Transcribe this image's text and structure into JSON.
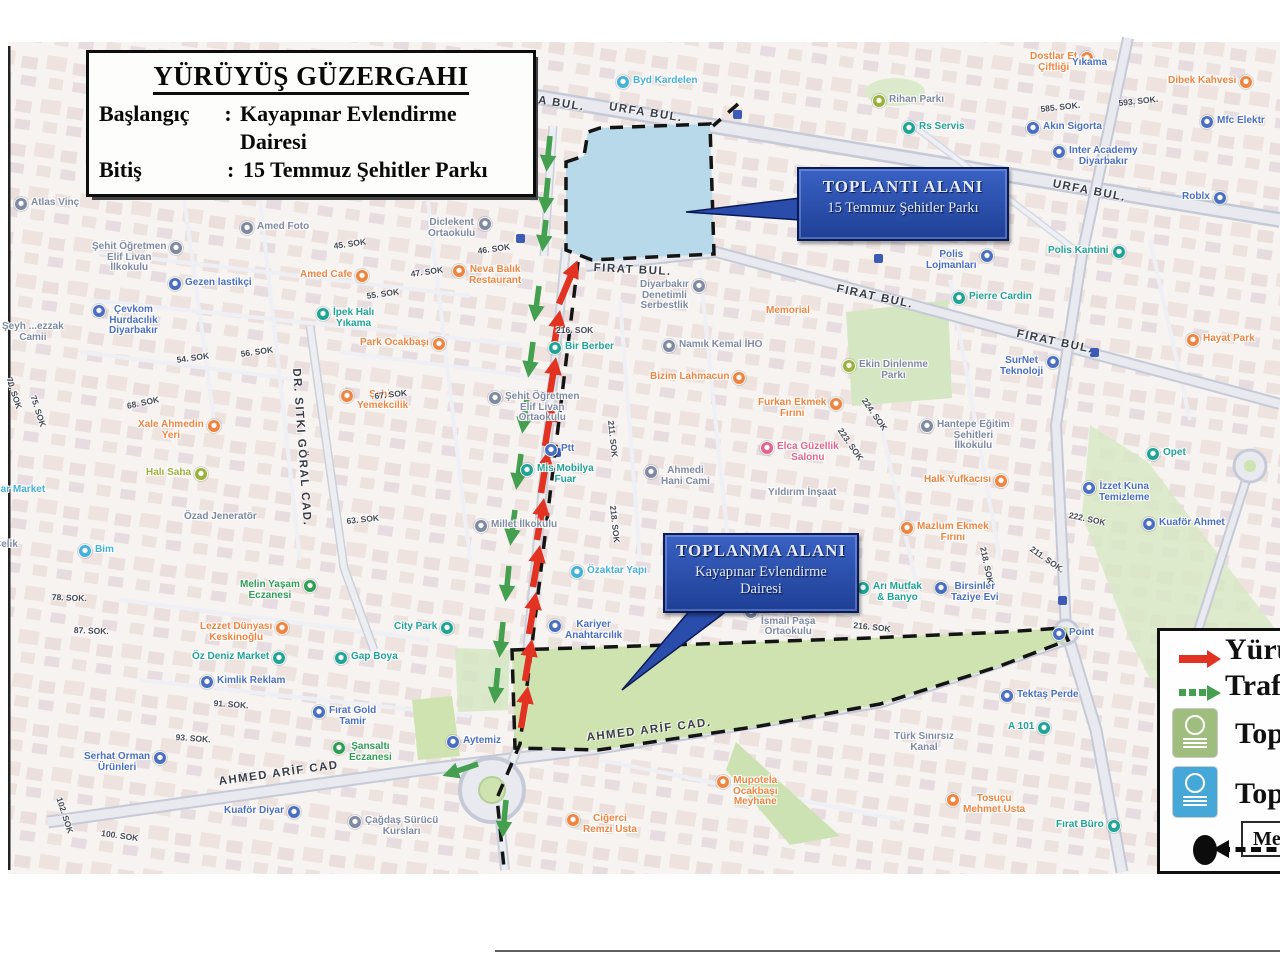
{
  "title_box": {
    "title": "YÜRÜYÜŞ GÜZERGAHI",
    "rows": [
      {
        "label": "Başlangıç",
        "colon": ":",
        "value": "Kayapınar Evlendirme Dairesi"
      },
      {
        "label": "Bitiş",
        "colon": ":",
        "value": "15 Temmuz Şehitler Parkı"
      }
    ]
  },
  "callouts": {
    "toplanti": {
      "line1": "TOPLANTI ALANI",
      "line2": "15 Temmuz Şehitler Parkı"
    },
    "toplanma": {
      "line1": "TOPLANMA ALANI",
      "line2": "Kayapınar Evlendirme",
      "line3": "Dairesi"
    }
  },
  "legend": {
    "items": [
      {
        "marker": "red-arrow",
        "label": "Yürüy"
      },
      {
        "marker": "green-arrow",
        "label": "Trafi"
      },
      {
        "marker": "green-badge",
        "label": "Topla"
      },
      {
        "marker": "blue-badge",
        "label": "Topla"
      }
    ],
    "scale_label": "Me"
  },
  "map": {
    "colors": {
      "blue": "#4a6fc0",
      "lightblue": "#45b0da",
      "teal": "#1fa396",
      "orange": "#ef8440",
      "green": "#2f9e55",
      "lime": "#9ab23c",
      "slate": "#7e89a2",
      "pink": "#e2648c",
      "walk_route": "#e23222",
      "traffic_route": "#44a04f",
      "park_blue": "#b7d9e9",
      "park_green": "#cfe3b0",
      "callout_blue": "#2a4cab"
    },
    "road_labels": [
      {
        "t": "URFA BUL.",
        "x": 512,
        "y": 90,
        "r": 9
      },
      {
        "t": "URFA BUL.",
        "x": 610,
        "y": 101,
        "r": 9
      },
      {
        "t": "URFA BUL.",
        "x": 1054,
        "y": 178,
        "r": 11
      },
      {
        "t": "FIRAT BUL.",
        "x": 594,
        "y": 262,
        "r": 3
      },
      {
        "t": "FIRAT BUL.",
        "x": 838,
        "y": 283,
        "r": 12
      },
      {
        "t": "FIRAT BUL.",
        "x": 1018,
        "y": 328,
        "r": 12
      },
      {
        "t": "AHMED ARİF CAD",
        "x": 218,
        "y": 776,
        "r": -8
      },
      {
        "t": "AHMED ARİF CAD.",
        "x": 586,
        "y": 732,
        "r": -7
      },
      {
        "t": "DR. SITKI GÖRAL CAD.",
        "x": 302,
        "y": 368,
        "r": 86
      },
      {
        "t": "SELAHADDİN",
        "x": 1180,
        "y": 674,
        "r": 80
      }
    ],
    "street_labels": [
      {
        "t": "46. SOK",
        "x": 477,
        "y": 246,
        "r": -8
      },
      {
        "t": "45. SOK",
        "x": 333,
        "y": 241,
        "r": -8
      },
      {
        "t": "47. SOK",
        "x": 410,
        "y": 269,
        "r": -8
      },
      {
        "t": "55. SOK",
        "x": 366,
        "y": 291,
        "r": -8
      },
      {
        "t": "54. SOK",
        "x": 176,
        "y": 355,
        "r": -8
      },
      {
        "t": "56. SOK",
        "x": 240,
        "y": 349,
        "r": -8
      },
      {
        "t": "68. SOK",
        "x": 126,
        "y": 401,
        "r": -12
      },
      {
        "t": "67. SOK",
        "x": 374,
        "y": 391,
        "r": -6
      },
      {
        "t": "63. SOK",
        "x": 346,
        "y": 516,
        "r": -6
      },
      {
        "t": "216. SOK",
        "x": 556,
        "y": 325,
        "r": 0
      },
      {
        "t": "211. SOK",
        "x": 616,
        "y": 420,
        "r": 84
      },
      {
        "t": "218. SOK",
        "x": 618,
        "y": 505,
        "r": 84
      },
      {
        "t": "585. SOK.",
        "x": 1040,
        "y": 104,
        "r": -6
      },
      {
        "t": "593. SOK.",
        "x": 1118,
        "y": 98,
        "r": -6
      },
      {
        "t": "224. SOK",
        "x": 868,
        "y": 396,
        "r": 55
      },
      {
        "t": "223. SOK",
        "x": 844,
        "y": 426,
        "r": 55
      },
      {
        "t": "222. SOK",
        "x": 1070,
        "y": 510,
        "r": 12
      },
      {
        "t": "211. SOK.",
        "x": 1034,
        "y": 544,
        "r": 35
      },
      {
        "t": "218. SOK",
        "x": 988,
        "y": 546,
        "r": 78
      },
      {
        "t": "216. SOK",
        "x": 854,
        "y": 620,
        "r": 6
      },
      {
        "t": "78. SOK.",
        "x": 52,
        "y": 592,
        "r": 2
      },
      {
        "t": "87. SOK.",
        "x": 74,
        "y": 625,
        "r": 2
      },
      {
        "t": "91. SOK.",
        "x": 214,
        "y": 698,
        "r": 4
      },
      {
        "t": "93. SOK.",
        "x": 176,
        "y": 732,
        "r": 4
      },
      {
        "t": "102. SOK",
        "x": 64,
        "y": 796,
        "r": 72
      },
      {
        "t": "100. SOK",
        "x": 102,
        "y": 828,
        "r": 8
      },
      {
        "t": "70. SOK",
        "x": 14,
        "y": 376,
        "r": 72
      },
      {
        "t": "75. SOK",
        "x": 38,
        "y": 394,
        "r": 72
      }
    ],
    "pois": [
      {
        "c": "lightblue",
        "x": 616,
        "y": 76,
        "l": [
          "Byd Kardelen"
        ]
      },
      {
        "c": "slate",
        "ic": "lime",
        "x": 872,
        "y": 95,
        "l": [
          "Rihan Parkı"
        ]
      },
      {
        "c": "orange",
        "x": 1030,
        "y": 52,
        "s": "r",
        "l": [
          "Dostlar Et",
          "Çiftliği"
        ]
      },
      {
        "c": "blue",
        "x": 1072,
        "y": 58,
        "ni": true,
        "l": [
          "Yıkama"
        ]
      },
      {
        "c": "teal",
        "x": 902,
        "y": 122,
        "l": [
          "Rs Servis"
        ]
      },
      {
        "c": "orange",
        "x": 1168,
        "y": 76,
        "s": "r",
        "l": [
          "Dibek Kahvesi"
        ]
      },
      {
        "c": "blue",
        "x": 1200,
        "y": 116,
        "l": [
          "Mfc Elektr"
        ]
      },
      {
        "c": "blue",
        "x": 1026,
        "y": 122,
        "l": [
          "Akın Sigorta"
        ]
      },
      {
        "c": "blue",
        "x": 1052,
        "y": 146,
        "l": [
          "Inter Academy",
          "Diyarbakır"
        ]
      },
      {
        "c": "blue",
        "x": 1182,
        "y": 192,
        "s": "r",
        "l": [
          "Roblx"
        ]
      },
      {
        "c": "slate",
        "x": 108,
        "y": 168,
        "l": [
          "Vali Ahmet",
          "Cemil Serhadlı",
          "Ortaokulu"
        ]
      },
      {
        "c": "slate",
        "x": 14,
        "y": 198,
        "l": [
          "Atlas Vinç"
        ]
      },
      {
        "c": "blue",
        "x": 352,
        "y": 180,
        "l": [
          "Türk Telekom"
        ]
      },
      {
        "c": "orange",
        "x": 468,
        "y": 182,
        "ni": true,
        "l": [
          "Komagene"
        ]
      },
      {
        "c": "slate",
        "x": 240,
        "y": 222,
        "l": [
          "Amed Foto"
        ]
      },
      {
        "c": "slate",
        "x": 428,
        "y": 218,
        "s": "r",
        "l": [
          "Diclekent",
          "Ortaokulu"
        ]
      },
      {
        "c": "slate",
        "x": 92,
        "y": 242,
        "s": "r",
        "l": [
          "Şehit Öğretmen",
          "Elif Livan",
          "İlkokulu"
        ]
      },
      {
        "c": "blue",
        "x": 168,
        "y": 278,
        "l": [
          "Gezen lastikçi"
        ]
      },
      {
        "c": "orange",
        "x": 300,
        "y": 270,
        "s": "r",
        "l": [
          "Amed Cafe"
        ]
      },
      {
        "c": "orange",
        "x": 452,
        "y": 265,
        "l": [
          "Neva Balık",
          "Restaurant"
        ]
      },
      {
        "c": "blue",
        "x": 92,
        "y": 305,
        "l": [
          "Çevkom",
          "Hurdacılık",
          "Diyarbakır"
        ]
      },
      {
        "c": "teal",
        "x": 316,
        "y": 308,
        "l": [
          "İpek Halı",
          "Yıkama"
        ]
      },
      {
        "c": "orange",
        "x": 360,
        "y": 338,
        "s": "r",
        "l": [
          "Park Ocakbaşı"
        ]
      },
      {
        "c": "orange",
        "x": 340,
        "y": 390,
        "l": [
          "Şahin",
          "Yemekcilik"
        ]
      },
      {
        "c": "orange",
        "x": 138,
        "y": 420,
        "s": "r",
        "l": [
          "Xale Ahmedin",
          "Yeri"
        ]
      },
      {
        "c": "lime",
        "x": 146,
        "y": 468,
        "s": "r",
        "l": [
          "Halı Saha"
        ]
      },
      {
        "c": "slate",
        "x": 184,
        "y": 512,
        "ni": true,
        "l": [
          "Özad Jeneratör"
        ]
      },
      {
        "c": "lightblue",
        "x": 78,
        "y": 545,
        "l": [
          "Bim"
        ]
      },
      {
        "c": "lightblue",
        "x": -26,
        "y": 485,
        "ni": true,
        "l": [
          "Yağmar Market"
        ]
      },
      {
        "c": "slate",
        "x": -6,
        "y": 540,
        "ni": true,
        "l": [
          "Çelik"
        ]
      },
      {
        "c": "slate",
        "x": 2,
        "y": 322,
        "ni": true,
        "l": [
          "Şeyh ...ezzak",
          "Camii"
        ]
      },
      {
        "c": "teal",
        "x": 548,
        "y": 342,
        "l": [
          "Bir Berber"
        ]
      },
      {
        "c": "slate",
        "x": 488,
        "y": 392,
        "l": [
          "Şehit Öğretmen",
          "Elif Livan",
          "Ortaokulu"
        ]
      },
      {
        "c": "blue",
        "x": 544,
        "y": 444,
        "l": [
          "Ptt"
        ]
      },
      {
        "c": "teal",
        "x": 520,
        "y": 464,
        "l": [
          "Mis Mobilya",
          "Fuar"
        ]
      },
      {
        "c": "slate",
        "x": 474,
        "y": 520,
        "l": [
          "Millet İlkokulu"
        ]
      },
      {
        "c": "lightblue",
        "x": 570,
        "y": 566,
        "l": [
          "Özaktar Yapı"
        ]
      },
      {
        "c": "blue",
        "x": 548,
        "y": 620,
        "l": [
          "Kariyer",
          "Anahtarcılık"
        ]
      },
      {
        "c": "slate",
        "x": 644,
        "y": 466,
        "l": [
          "Ahmedi",
          "Hani Cami"
        ]
      },
      {
        "c": "orange",
        "x": 650,
        "y": 372,
        "s": "r",
        "l": [
          "Bizim Lahmacun"
        ]
      },
      {
        "c": "slate",
        "x": 640,
        "y": 280,
        "s": "r",
        "l": [
          "Diyarbakır",
          "Denetimli",
          "Serbestlik"
        ]
      },
      {
        "c": "slate",
        "x": 662,
        "y": 340,
        "l": [
          "Namık Kemal İHO"
        ]
      },
      {
        "c": "orange",
        "x": 766,
        "y": 306,
        "ni": true,
        "l": [
          "Memorial"
        ]
      },
      {
        "c": "orange",
        "x": 758,
        "y": 398,
        "s": "r",
        "l": [
          "Furkan Ekmek",
          "Fırını"
        ]
      },
      {
        "c": "pink",
        "x": 760,
        "y": 442,
        "l": [
          "Elca Güzellik",
          "Salonu"
        ]
      },
      {
        "c": "slate",
        "x": 768,
        "y": 488,
        "ni": true,
        "l": [
          "Yıldırım İnşaat"
        ]
      },
      {
        "c": "slate",
        "ic": "lime",
        "x": 842,
        "y": 360,
        "l": [
          "Ekin Dinlenme",
          "Parkı"
        ]
      },
      {
        "c": "orange",
        "x": 900,
        "y": 522,
        "l": [
          "Mazlum Ekmek",
          "Fırını"
        ]
      },
      {
        "c": "teal",
        "x": 856,
        "y": 582,
        "l": [
          "Arı Mutfak",
          "& Banyo"
        ]
      },
      {
        "c": "blue",
        "x": 934,
        "y": 582,
        "l": [
          "Birsinler",
          "Taziye Evi"
        ]
      },
      {
        "c": "slate",
        "x": 920,
        "y": 420,
        "l": [
          "Hantepe Eğitim",
          "Şehitleri",
          "İlkokulu"
        ]
      },
      {
        "c": "orange",
        "x": 924,
        "y": 475,
        "s": "r",
        "l": [
          "Halk Yufkacısı"
        ]
      },
      {
        "c": "blue",
        "x": 1082,
        "y": 482,
        "l": [
          "İzzet Kuna",
          "Temizleme"
        ]
      },
      {
        "c": "blue",
        "x": 1142,
        "y": 518,
        "l": [
          "Kuaför Ahmet"
        ]
      },
      {
        "c": "teal",
        "x": 1146,
        "y": 448,
        "l": [
          "Opet"
        ]
      },
      {
        "c": "orange",
        "x": 1186,
        "y": 334,
        "l": [
          "Hayat Park"
        ]
      },
      {
        "c": "teal",
        "x": 952,
        "y": 292,
        "l": [
          "Pierre Cardin"
        ]
      },
      {
        "c": "blue",
        "x": 926,
        "y": 250,
        "s": "r",
        "l": [
          "Polis",
          "Lojmanları"
        ]
      },
      {
        "c": "teal",
        "x": 1048,
        "y": 246,
        "s": "r",
        "l": [
          "Polis Kantini"
        ]
      },
      {
        "c": "blue",
        "x": 1000,
        "y": 356,
        "s": "r",
        "l": [
          "SurNet",
          "Teknoloji"
        ]
      },
      {
        "c": "green",
        "x": 240,
        "y": 580,
        "s": "r",
        "l": [
          "Melin Yaşam",
          "Eczanesi"
        ]
      },
      {
        "c": "orange",
        "x": 200,
        "y": 622,
        "s": "r",
        "l": [
          "Lezzet Dünyası",
          "Keskinoğlu"
        ]
      },
      {
        "c": "teal",
        "x": 192,
        "y": 652,
        "s": "r",
        "l": [
          "Öz Deniz Market"
        ]
      },
      {
        "c": "blue",
        "x": 200,
        "y": 676,
        "l": [
          "Kimlik Reklam"
        ]
      },
      {
        "c": "teal",
        "x": 394,
        "y": 622,
        "s": "r",
        "l": [
          "City Park"
        ]
      },
      {
        "c": "teal",
        "x": 334,
        "y": 652,
        "l": [
          "Gap Boya"
        ]
      },
      {
        "c": "blue",
        "x": 312,
        "y": 706,
        "l": [
          "Fırat Gold",
          "Tamir"
        ]
      },
      {
        "c": "green",
        "x": 332,
        "y": 742,
        "l": [
          "Şansaltı",
          "Eczanesi"
        ]
      },
      {
        "c": "blue",
        "x": 84,
        "y": 752,
        "s": "r",
        "l": [
          "Serhat Orman",
          "Ürünleri"
        ]
      },
      {
        "c": "blue",
        "x": 446,
        "y": 736,
        "l": [
          "Aytemiz"
        ]
      },
      {
        "c": "blue",
        "x": 224,
        "y": 806,
        "s": "r",
        "l": [
          "Kuaför Diyar"
        ]
      },
      {
        "c": "slate",
        "x": 348,
        "y": 816,
        "l": [
          "Çağdaş Sürücü",
          "Kursları"
        ]
      },
      {
        "c": "orange",
        "x": 566,
        "y": 814,
        "l": [
          "Ciğerci",
          "Remzi Usta"
        ]
      },
      {
        "c": "orange",
        "x": 716,
        "y": 776,
        "l": [
          "Mupotela",
          "Ocakbaşı",
          "Meyhane"
        ]
      },
      {
        "c": "orange",
        "x": 946,
        "y": 794,
        "l": [
          "Tosuçu",
          "Mehmet Usta"
        ]
      },
      {
        "c": "blue",
        "x": 1000,
        "y": 690,
        "l": [
          "Tektaş Perde"
        ]
      },
      {
        "c": "teal",
        "x": 1008,
        "y": 722,
        "s": "r",
        "l": [
          "A 101"
        ]
      },
      {
        "c": "teal",
        "x": 1056,
        "y": 820,
        "s": "r",
        "l": [
          "Fırat Büro"
        ]
      },
      {
        "c": "slate",
        "x": 894,
        "y": 732,
        "ni": true,
        "l": [
          "Türk Sınırsız",
          "Kanal"
        ]
      },
      {
        "c": "slate",
        "x": 744,
        "y": 606,
        "l": [
          "Vali Kurt",
          "İsmail Paşa",
          "Ortaokulu"
        ]
      },
      {
        "c": "blue",
        "x": 1052,
        "y": 628,
        "l": [
          "Point"
        ]
      }
    ]
  }
}
